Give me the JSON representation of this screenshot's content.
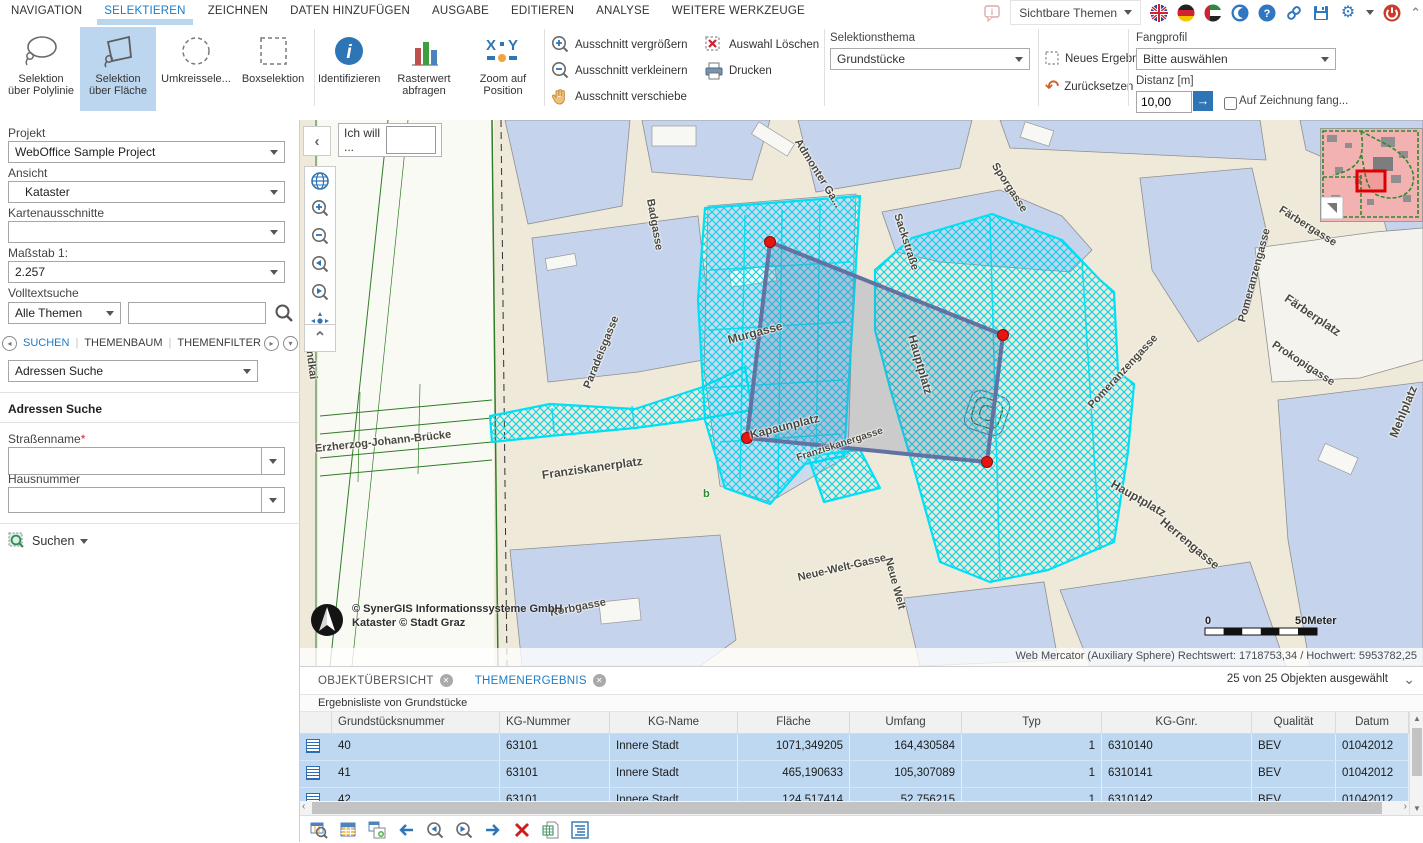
{
  "menubar": {
    "tabs": [
      "NAVIGATION",
      "SELEKTIEREN",
      "ZEICHNEN",
      "DATEN HINZUFÜGEN",
      "AUSGABE",
      "EDITIEREN",
      "ANALYSE",
      "WEITERE WERKZEUGE"
    ],
    "active_tab": "SELEKTIEREN",
    "sichtbare_themen": "Sichtbare Themen"
  },
  "ribbon": {
    "sel_poly_1": "Selektion",
    "sel_poly_2": "über Polylinie",
    "sel_area_1": "Selektion",
    "sel_area_2": "über Fläche",
    "umkreis": "Umkreissele...",
    "box": "Boxselektion",
    "ident": "Identifizieren",
    "raster_1": "Rasterwert",
    "raster_2": "abfragen",
    "zoompos_1": "Zoom auf",
    "zoompos_2": "Position",
    "fav_zoom_in": "Ausschnitt vergrößern",
    "fav_zoom_out": "Ausschnitt verkleinern",
    "fav_pan": "Ausschnitt verschiebe",
    "fav_clear": "Auswahl Löschen",
    "fav_print": "Drucken",
    "groups": {
      "sel": "Selektieren",
      "ident": "Identifizieren",
      "fav": "Favoriten"
    },
    "selektionsthema": {
      "label": "Selektionsthema",
      "value": "Grundstücke"
    },
    "neues_ergebnis": "Neues Ergebnis",
    "zuruecksetzen": "Zurücksetzen",
    "fangprofil": {
      "label": "Fangprofil",
      "value": "Bitte auswählen"
    },
    "distanz": {
      "label": "Distanz [m]",
      "value": "10,00"
    },
    "fang_checkbox_label": "Auf Zeichnung fang..."
  },
  "sidebar": {
    "projekt": {
      "label": "Projekt",
      "value": "WebOffice Sample Project"
    },
    "ansicht": {
      "label": "Ansicht",
      "value": "Kataster"
    },
    "kartenausschnitte": {
      "label": "Kartenausschnitte",
      "value": ""
    },
    "massstab": {
      "label": "Maßstab 1:",
      "value": "2.257"
    },
    "volltextsuche": {
      "label": "Volltextsuche",
      "scope": "Alle Themen"
    },
    "tabs": [
      "SUCHEN",
      "THEMENBAUM",
      "THEMENFILTER"
    ],
    "active_tab": "SUCHEN",
    "search_type": "Adressen Suche",
    "section_title": "Adressen Suche",
    "strassenname_label": "Straßenname",
    "required_mark": "*",
    "hausnummer_label": "Hausnummer",
    "suchen_label": "Suchen"
  },
  "map": {
    "ich_will": "Ich will ...",
    "copyright_line1": "© SynerGIS Informationssysteme GmbH",
    "copyright_line2": "Kataster © Stadt Graz",
    "scale": {
      "start": "0",
      "end": "50Meter"
    },
    "status": "Web Mercator (Auxiliary Sphere) Rechtswert: 1718753,34 / Hochwert: 5953782,25",
    "streets": [
      {
        "name": "Admonter Ga...",
        "x": 497,
        "y": 14,
        "r": 58
      },
      {
        "name": "Sporgasse",
        "x": 694,
        "y": 38,
        "r": 57
      },
      {
        "name": "Sackstraße",
        "x": 597,
        "y": 88,
        "r": 72
      },
      {
        "name": "Färbergasse",
        "x": 980,
        "y": 83,
        "r": 32
      },
      {
        "name": "Färberplatz",
        "x": 986,
        "y": 170,
        "r": 34,
        "s": 12
      },
      {
        "name": "Pomeranzengasse",
        "x": 942,
        "y": 196,
        "r": -75
      },
      {
        "name": "Pomeranzengasse",
        "x": 790,
        "y": 281,
        "r": -47
      },
      {
        "name": "Prokopigasse",
        "x": 973,
        "y": 218,
        "r": 33
      },
      {
        "name": "Mehlplatz",
        "x": 1093,
        "y": 310,
        "r": -68,
        "s": 12
      },
      {
        "name": "Murgasse",
        "x": 428,
        "y": 213,
        "r": -15,
        "s": 12
      },
      {
        "name": "Hauptplatz",
        "x": 612,
        "y": 208,
        "r": 74,
        "s": 12
      },
      {
        "name": "Hauptplatz",
        "x": 812,
        "y": 356,
        "r": 30,
        "s": 12
      },
      {
        "name": "Kapaunplatz",
        "x": 450,
        "y": 308,
        "r": -14,
        "s": 12
      },
      {
        "name": "Franziskanergasse",
        "x": 497,
        "y": 333,
        "r": -18,
        "s": 10
      },
      {
        "name": "Franziskanerplatz",
        "x": 242,
        "y": 348,
        "r": -8,
        "s": 12
      },
      {
        "name": "Erzherzog-Johann-Brücke",
        "x": 15,
        "y": 323,
        "r": -6
      },
      {
        "name": "Lendkai",
        "x": 8,
        "y": 212,
        "r": 83
      },
      {
        "name": "Herrengasse",
        "x": 862,
        "y": 393,
        "r": 40,
        "s": 12
      },
      {
        "name": "Neue-Welt-Gasse",
        "x": 498,
        "y": 452,
        "r": -13
      },
      {
        "name": "Neue Welt",
        "x": 588,
        "y": 432,
        "r": 75
      },
      {
        "name": "Korbgasse",
        "x": 250,
        "y": 487,
        "r": -11
      },
      {
        "name": "Badgasse",
        "x": 350,
        "y": 73,
        "r": 80
      },
      {
        "name": "Paradeisgasse",
        "x": 287,
        "y": 262,
        "r": -68
      },
      {
        "name": "b",
        "x": 403,
        "y": 368,
        "r": 0,
        "c": "#2e8b2e"
      }
    ]
  },
  "results": {
    "tabs": [
      {
        "label": "OBJEKTÜBERSICHT",
        "active": false
      },
      {
        "label": "THEMENERGEBNIS",
        "active": true
      }
    ],
    "selection_status": "25 von 25 Objekten ausgewählt",
    "list_title": "Ergebnisliste von Grundstücke",
    "table": {
      "columns": [
        "Grundstücksnummer",
        "KG-Nummer",
        "KG-Name",
        "Fläche",
        "Umfang",
        "Typ",
        "KG-Gnr.",
        "Qualität",
        "Datum"
      ],
      "rows": [
        [
          "40",
          "63101",
          "Innere Stadt",
          "1071,349205",
          "164,430584",
          "1",
          "6310140",
          "BEV",
          "01042012"
        ],
        [
          "41",
          "63101",
          "Innere Stadt",
          "465,190633",
          "105,307089",
          "1",
          "6310141",
          "BEV",
          "01042012"
        ],
        [
          "42",
          "63101",
          "Innere Stadt",
          "124,517414",
          "52,756215",
          "1",
          "6310142",
          "BEV",
          "01042012"
        ]
      ]
    }
  }
}
